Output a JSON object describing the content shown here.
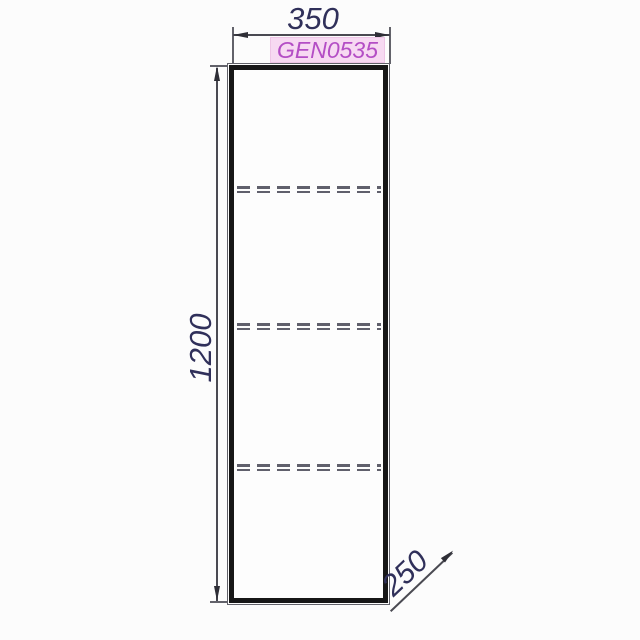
{
  "drawing": {
    "product_code": "GEN0535",
    "dimensions": {
      "width": "350",
      "height": "1200",
      "depth": "250"
    },
    "shelves": {
      "count": 3,
      "style": "dashed"
    },
    "colors": {
      "dimension_text": "#30305a",
      "dimension_line": "#4a4a52",
      "arrow": "#2e2e36",
      "outline_thick": "#171717",
      "outline_thin": "#62626a",
      "shelf_dash": "#60606c",
      "code_text": "#b44ec5",
      "code_bg": "#f7d9f2",
      "code_border": "#eec5e6",
      "background": "#fcfcfc"
    }
  }
}
